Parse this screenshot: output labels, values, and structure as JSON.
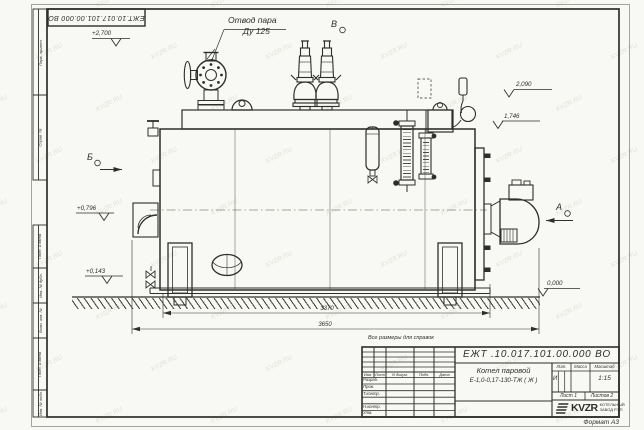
{
  "watermark": {
    "text": "KVZR.RU"
  },
  "frame": {
    "designation_rotated": "ЕЖТ.10.017.101.00.000  ВО",
    "side_labels": {
      "perv_primen": "Перв. примен.",
      "sprav_no": "Справ. №",
      "podp_data1": "Подп. и дата",
      "inv_dubl": "Инв. № дубл.",
      "vzam_inv": "Взам. инв. №",
      "podp_data2": "Подп. и дата",
      "inv_podl": "Инв. № подл."
    }
  },
  "drawing": {
    "callout": {
      "line1": "Отвод пара",
      "line2": "Ду 125"
    },
    "views": {
      "b": "Б",
      "v": "В",
      "a": "А"
    },
    "elevations": {
      "top": "+2,700",
      "upper_right": "2,090",
      "mid_right": "1,746",
      "left_mid": "+0,796",
      "left_low": "+0,143",
      "ground": "0,000"
    },
    "dimensions": {
      "shell_length": "3370",
      "overall_length": "3650"
    },
    "note": "Все размеры для справок"
  },
  "title_block": {
    "designation": "ЕЖТ .10.017.101.00.000  ВО",
    "name_line1": "Котел паровой",
    "name_line2": "Е-1,0-0,17-130-ТЖ ( Ж )",
    "col_headers": {
      "izm": "Изм.",
      "list": "Лист",
      "doc": "N докум.",
      "podp": "Подп.",
      "data": "Дата"
    },
    "rows": {
      "razrab": "Разраб.",
      "prov": "Пров.",
      "tkontr": "Т.контр.",
      "nkontr": "Н.контр.",
      "utv": "Утв."
    },
    "lit_header": "Лит.",
    "mass_header": "Масса",
    "scale_header": "Масштаб",
    "lit_value": "И",
    "scale_value": "1:15",
    "sheet": "Лист 1",
    "sheets": "Листов 2",
    "logo": {
      "text": "KVZR",
      "sub1": "КОТЕЛЬНЫЙ",
      "sub2": "ЗАВОД РЭП"
    },
    "format": "Формат А3"
  }
}
